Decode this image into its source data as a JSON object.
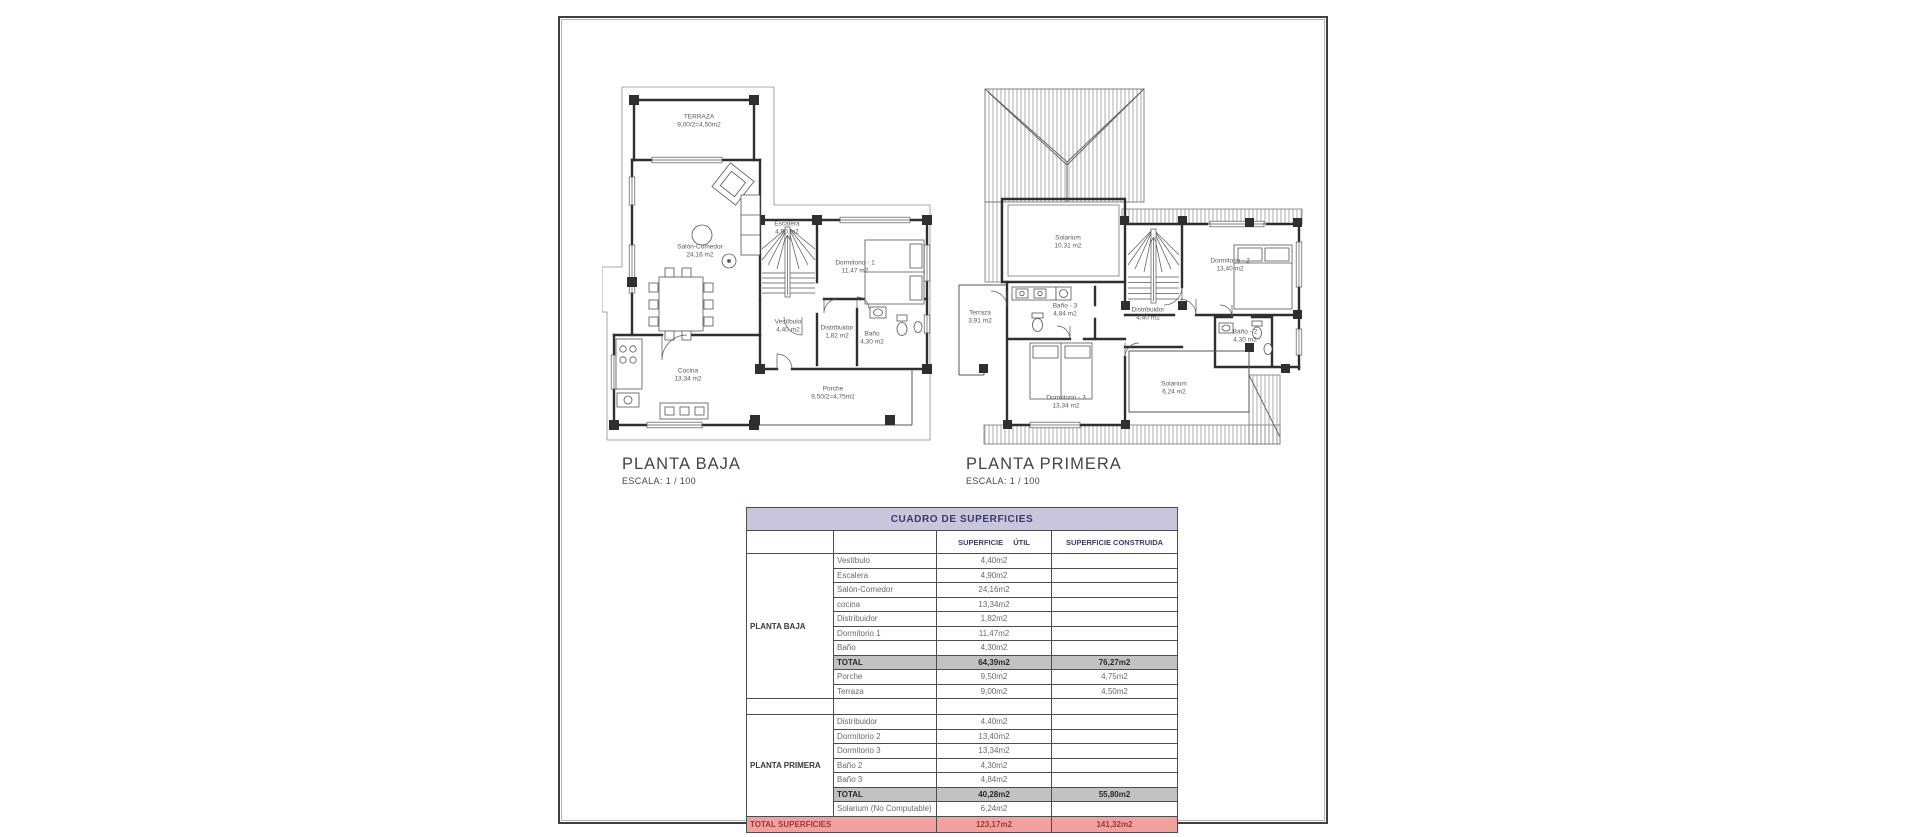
{
  "sheet": {
    "border_color": "#3f3f3f",
    "inner_line_color": "#b5b5b5"
  },
  "plans": [
    {
      "title": "PLANTA BAJA",
      "scale_label": "ESCALA: 1 / 100",
      "rooms": [
        {
          "name": "TERRAZA",
          "area": "9,00/2=4,50m2",
          "x": 139,
          "y": 104
        },
        {
          "name": "Salón-Comedor",
          "area": "24,16 m2",
          "x": 140,
          "y": 234
        },
        {
          "name": "Escalera",
          "area": "4,90 m2",
          "x": 227,
          "y": 211
        },
        {
          "name": "Dormitorio - 1",
          "area": "11,47 m2",
          "x": 295,
          "y": 250
        },
        {
          "name": "Vestíbulo",
          "area": "4,40 m2",
          "x": 228,
          "y": 309
        },
        {
          "name": "Distribuidor",
          "area": "1,82 m2",
          "x": 277,
          "y": 315
        },
        {
          "name": "Baño",
          "area": "4,30 m2",
          "x": 312,
          "y": 321
        },
        {
          "name": "Cocina",
          "area": "13,34 m2",
          "x": 128,
          "y": 358
        },
        {
          "name": "Porche",
          "area": "9,50/2=4,75m2",
          "x": 273,
          "y": 376
        }
      ]
    },
    {
      "title": "PLANTA PRIMERA",
      "scale_label": "ESCALA: 1 / 100",
      "rooms": [
        {
          "name": "Solarium",
          "area": "10,31 m2",
          "x": 508,
          "y": 225
        },
        {
          "name": "Dormitorio - 2",
          "area": "13,40 m2",
          "x": 670,
          "y": 248
        },
        {
          "name": "Terraza",
          "area": "3,91 m2",
          "x": 420,
          "y": 300
        },
        {
          "name": "Baño - 3",
          "area": "4,84 m2",
          "x": 505,
          "y": 293
        },
        {
          "name": "Distribuidor",
          "area": "4,40 m2",
          "x": 588,
          "y": 297
        },
        {
          "name": "Baño - 2",
          "area": "4,30 m2",
          "x": 685,
          "y": 319
        },
        {
          "name": "Dormitorio - 3",
          "area": "13,34 m2",
          "x": 506,
          "y": 385
        },
        {
          "name": "Solarium",
          "area": "6,24 m2",
          "x": 614,
          "y": 371
        }
      ]
    }
  ],
  "surface_table": {
    "title": "CUADRO DE SUPERFICIES",
    "columns": {
      "util": "SUPERFICIE ÚTIL",
      "construida": "SUPERFICIE CONSTRUIDA"
    },
    "colors": {
      "header_bg": "#c8c5dc",
      "header_text": "#3b3a67",
      "total_bg": "#c2c2c2",
      "total_text": "#2a2a2a",
      "footer_bg": "#f2a19e",
      "footer_text": "#9c3832"
    },
    "sections": [
      {
        "group": "PLANTA BAJA",
        "rows": [
          {
            "type": "data",
            "name": "Vestíbulo",
            "util": "4,40m2",
            "construida": ""
          },
          {
            "type": "data",
            "name": "Escalera",
            "util": "4,90m2",
            "construida": ""
          },
          {
            "type": "data",
            "name": "Salón-Comedor",
            "util": "24,16m2",
            "construida": ""
          },
          {
            "type": "data",
            "name": "cocina",
            "util": "13,34m2",
            "construida": ""
          },
          {
            "type": "data",
            "name": "Distribuidor",
            "util": "1,82m2",
            "construida": ""
          },
          {
            "type": "data",
            "name": "Dormitorio 1",
            "util": "11,47m2",
            "construida": ""
          },
          {
            "type": "data",
            "name": "Baño",
            "util": "4,30m2",
            "construida": ""
          },
          {
            "type": "total",
            "name": "TOTAL",
            "util": "64,39m2",
            "construida": "76,27m2"
          },
          {
            "type": "data",
            "name": "Porche",
            "util": "9,50m2",
            "construida": "4,75m2"
          },
          {
            "type": "data",
            "name": "Terraza",
            "util": "9,00m2",
            "construida": "4,50m2"
          }
        ]
      },
      {
        "group": "PLANTA PRIMERA",
        "rows": [
          {
            "type": "data",
            "name": "Distribuidor",
            "util": "4,40m2",
            "construida": ""
          },
          {
            "type": "data",
            "name": "Dormitorio 2",
            "util": "13,40m2",
            "construida": ""
          },
          {
            "type": "data",
            "name": "Dormitorio 3",
            "util": "13,34m2",
            "construida": ""
          },
          {
            "type": "data",
            "name": "Baño 2",
            "util": "4,30m2",
            "construida": ""
          },
          {
            "type": "data",
            "name": "Baño 3",
            "util": "4,84m2",
            "construida": ""
          },
          {
            "type": "total",
            "name": "TOTAL",
            "util": "40,28m2",
            "construida": "55,80m2"
          },
          {
            "type": "data",
            "name": "Solarium (No Computable)",
            "util": "6,24m2",
            "construida": ""
          }
        ]
      }
    ],
    "footer": {
      "label": "TOTAL SUPERFICIES",
      "util": "123,17m2",
      "construida": "141,32m2"
    }
  }
}
